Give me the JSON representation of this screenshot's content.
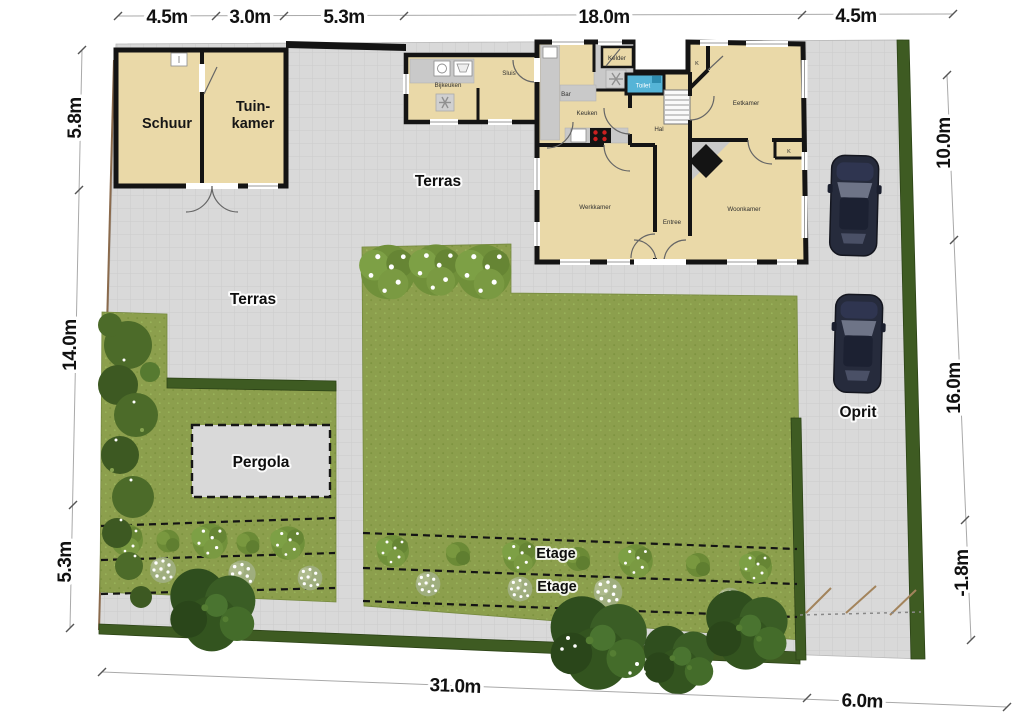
{
  "dimensions": {
    "top": [
      "4.5m",
      "3.0m",
      "5.3m",
      "18.0m",
      "4.5m"
    ],
    "left": [
      "5.8m",
      "14.0m",
      "5.3m"
    ],
    "right": [
      "10.0m",
      "16.0m",
      "-1.8m"
    ],
    "bottom": [
      "31.0m",
      "6.0m"
    ]
  },
  "outdoor": {
    "terras_upper": "Terras",
    "terras_lower": "Terras",
    "pergola": "Pergola",
    "oprit": "Oprit",
    "etage_upper": "Etage",
    "etage_lower": "Etage"
  },
  "outbuilding": {
    "schuur": "Schuur",
    "tuinkamer_line1": "Tuin-",
    "tuinkamer_line2": "kamer"
  },
  "house": {
    "bijkeuken": "Bijkeuken",
    "sluis": "Sluis",
    "kelder": "Kelder",
    "toilet": "Toilet",
    "bar": "Bar",
    "keuken": "Keuken",
    "hal": "Hal",
    "eetkamer": "Eetkamer",
    "werkkamer": "Werkkamer",
    "entree": "Entree",
    "woonkamer": "Woonkamer",
    "kast1": "K",
    "kast2": "K"
  },
  "colors": {
    "paving": "#d9d9d9",
    "lawn": "#8c9f4d",
    "hedge": "#3e5b22",
    "room": "#ead9a8",
    "wall": "#141414",
    "counter": "#c9c9c9",
    "toilet": "#55b4d7",
    "car": "#262b3c",
    "text": "#111111"
  }
}
